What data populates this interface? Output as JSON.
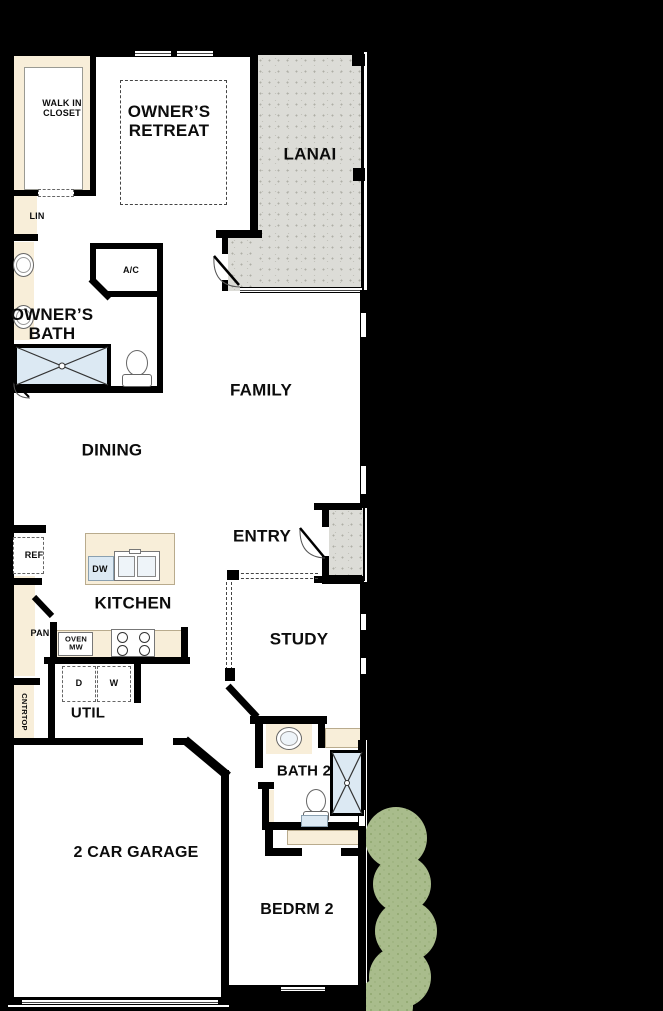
{
  "plan_title": "Single-story home floor plan",
  "rooms": {
    "walk_in_closet": "WALK IN\nCLOSET",
    "owners_retreat": "OWNER’S\nRETREAT",
    "lanai": "LANAI",
    "lin": "LIN",
    "ac": "A/C",
    "owners_bath": "OWNER’S\nBATH",
    "family": "FAMILY",
    "dining": "DINING",
    "entry": "ENTRY",
    "kitchen": "KITCHEN",
    "study": "STUDY",
    "util": "UTIL",
    "bath2": "BATH 2",
    "garage": "2 CAR GARAGE",
    "bedrm2": "BEDRM 2"
  },
  "callouts": {
    "ref": "REF",
    "dw": "DW",
    "pan": "PAN",
    "oven_mw": "OVEN\nMW",
    "dryer": "D",
    "washer": "W",
    "cntrtop": "CNTRTOP"
  },
  "icons": {
    "shower": "shower-x-icon",
    "toilet": "toilet-icon",
    "sink": "sink-icon",
    "kitchen_sink": "double-sink-icon",
    "cooktop": "cooktop-burners-icon",
    "door_swing": "door-swing-icon",
    "window": "window-icon",
    "shrub": "shrub-icon"
  },
  "colors": {
    "background": "#000000",
    "wall": "#000000",
    "floor": "#ffffff",
    "casework": "#f8eed9",
    "outdoor_gray": "#dcdcd7",
    "fixture_blue": "#dce9f3",
    "shrub_green": "#a9bc8c"
  }
}
